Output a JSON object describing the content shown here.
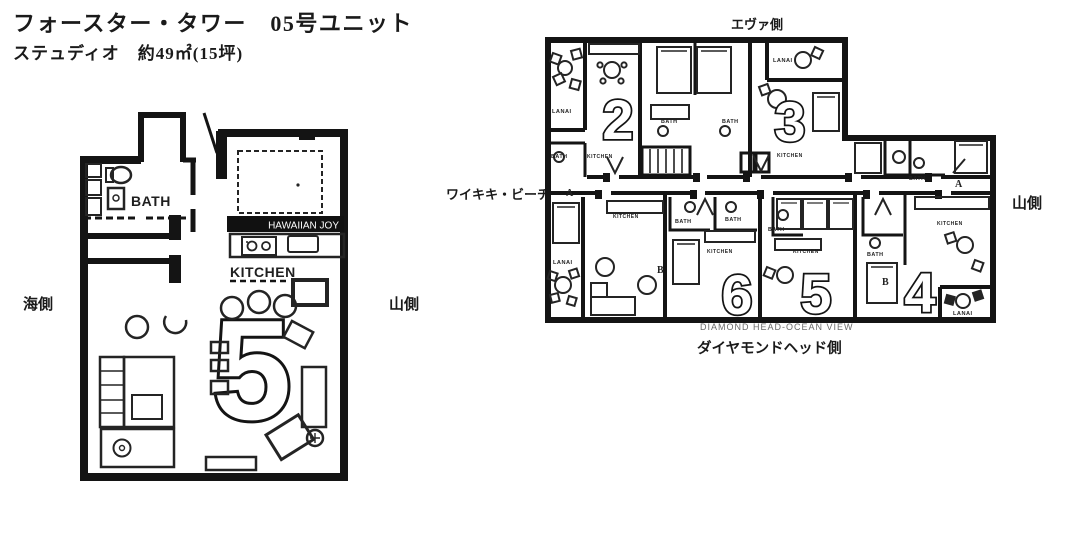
{
  "header": {
    "title": "フォースター・タワー　05号ユニット",
    "subtitle": "ステュディオ　約49㎡(15坪)"
  },
  "unit_plan": {
    "unit_number": "5",
    "banner": "HAWAIIAN JOY",
    "rooms": {
      "bath": "BATH",
      "kitchen": "KITCHEN"
    },
    "side_labels": {
      "left": "海側",
      "right": "山側"
    }
  },
  "building_plan": {
    "compass": {
      "top": "エヴァ側",
      "left": "ワイキキ・ビーチ",
      "right": "山側",
      "bottom": "ダイヤモンドヘッド側"
    },
    "caption": "DIAMOND HEAD-OCEAN VIEW",
    "units": [
      "2",
      "3",
      "4",
      "5",
      "6"
    ],
    "zones": [
      "A",
      "B"
    ],
    "rooms": {
      "bath": "BATH",
      "kitchen": "KITCHEN",
      "lanai": "LANAI"
    }
  },
  "colors": {
    "ink": "#141414",
    "banner_bg": "#111111",
    "banner_text": "#ffffff"
  }
}
